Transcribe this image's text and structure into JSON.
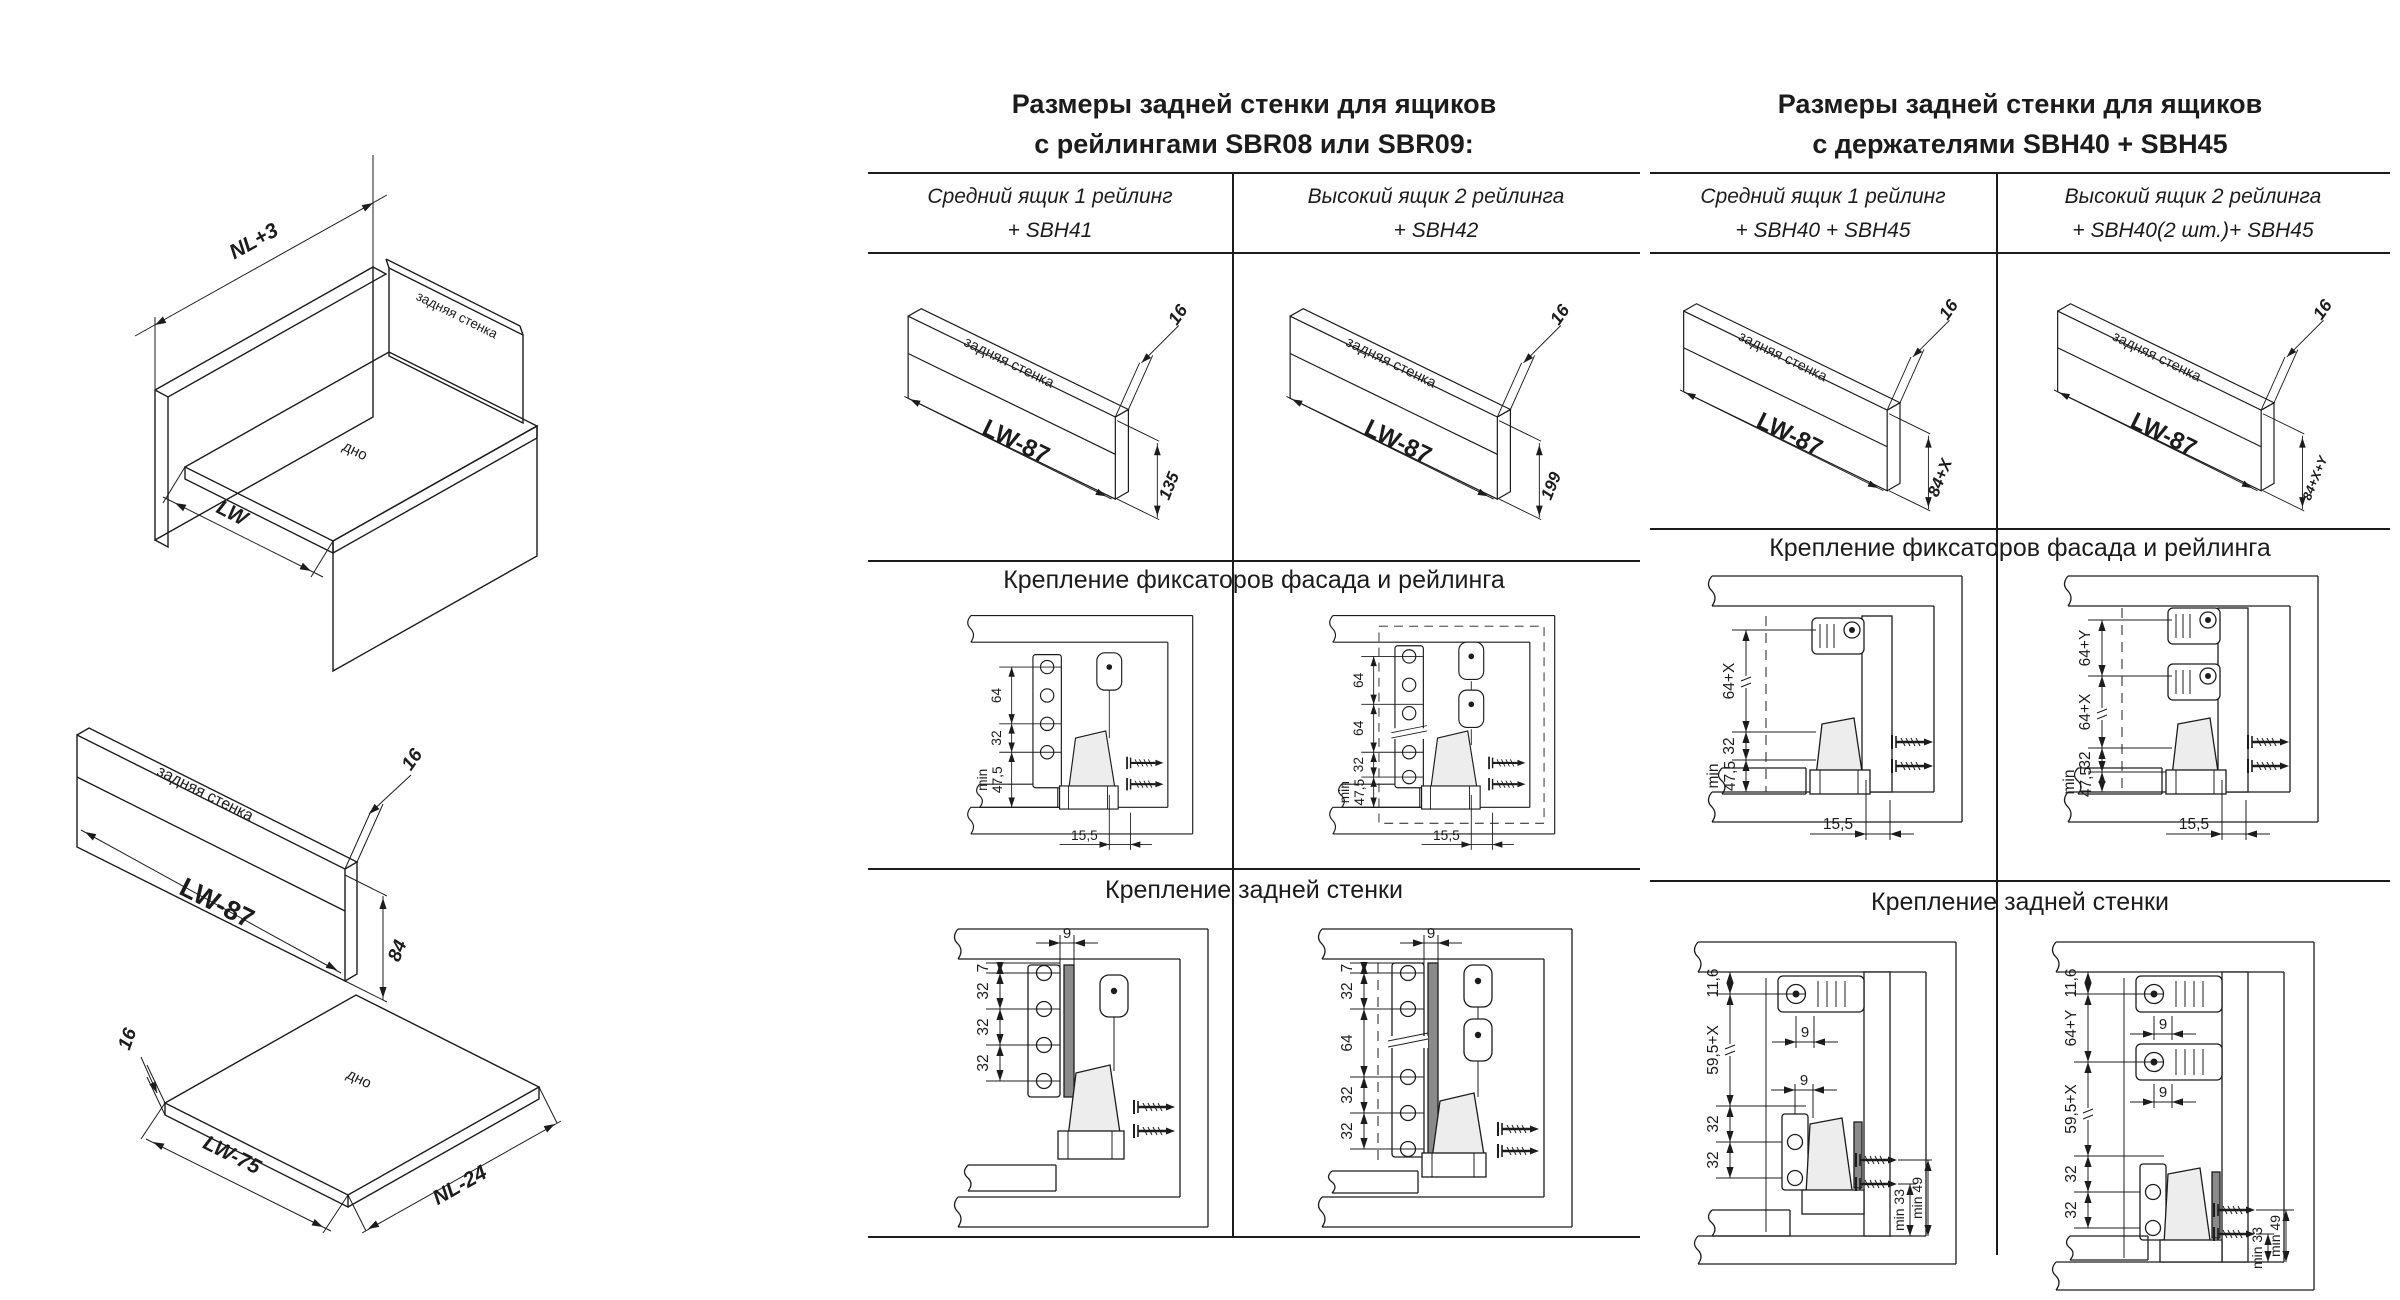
{
  "left_drawing": {
    "dim_length": "NL+3",
    "dim_width": "LW",
    "box_back_label": "задняя стенка",
    "box_bottom_label": "дно",
    "back_panel": {
      "name": "задняя стенка",
      "width": "LW-87",
      "thickness": "16",
      "height": "84"
    },
    "bottom_panel": {
      "name": "дно",
      "thickness": "16",
      "width": "LW-75",
      "depth": "NL-24"
    }
  },
  "tables": [
    {
      "title_line1": "Размеры задней стенки для ящиков",
      "title_line2": "с рейлингами SBR08 или SBR09:",
      "columns": [
        {
          "header_line1": "Средний ящик 1 рейлинг",
          "header_line2": "+ SBH41",
          "panel": {
            "name": "задняя стенка",
            "width": "LW-87",
            "thickness": "16",
            "height": "135"
          }
        },
        {
          "header_line1": "Высокий ящик 2 рейлинга",
          "header_line2": "+ SBH42",
          "panel": {
            "name": "задняя стенка",
            "width": "LW-87",
            "thickness": "16",
            "height": "199"
          }
        }
      ],
      "section1_title": "Крепление фиксаторов фасада и рейлинга",
      "section2_title": "Крепление задней стенки",
      "mount1": [
        {
          "type": "A",
          "chain": [
            "64",
            "32"
          ],
          "min_label": "min",
          "min_value": "47,5",
          "bottom": "15,5"
        },
        {
          "type": "A2",
          "chain": [
            "64",
            "64",
            "32"
          ],
          "min_label": "min",
          "min_value": "47,5",
          "bottom": "15,5"
        }
      ],
      "mount2": [
        {
          "type": "B",
          "top": "9",
          "chain": [
            "7",
            "32",
            "32",
            "32"
          ]
        },
        {
          "type": "B2",
          "top": "9",
          "chain": [
            "7",
            "32",
            "64",
            "32",
            "32"
          ]
        }
      ]
    },
    {
      "title_line1": "Размеры задней стенки для ящиков",
      "title_line2": "с держателями SBH40 + SBH45",
      "columns": [
        {
          "header_line1": "Средний ящик 1 рейлинг",
          "header_line2": "+ SBH40 + SBH45",
          "panel": {
            "name": "задняя стенка",
            "width": "LW-87",
            "thickness": "16",
            "height": "84+X"
          }
        },
        {
          "header_line1": "Высокий ящик 2 рейлинга",
          "header_line2": "+ SBH40(2 шт.)+ SBH45",
          "panel": {
            "name": "задняя стенка",
            "width": "LW-87",
            "thickness": "16",
            "height": "84+X+Y"
          }
        }
      ],
      "section1_title": "Крепление фиксаторов фасада и рейлинга",
      "section2_title": "Крепление задней стенки",
      "mount1": [
        {
          "type": "C",
          "chain": [
            "64+X",
            "32"
          ],
          "min_label": "min",
          "min_value": "47,5",
          "bottom": "15,5"
        },
        {
          "type": "C2",
          "chain": [
            "64+Y",
            "64+X",
            "32"
          ],
          "min_label": "min",
          "min_value": "47,5",
          "bottom": "15,5"
        }
      ],
      "mount2": [
        {
          "type": "D",
          "chain": [
            "11,6",
            "59,5+X",
            "32",
            "32"
          ],
          "hole_gap": "9",
          "min_back": "min 33",
          "min_front": "min 49"
        },
        {
          "type": "D2",
          "chain": [
            "11,6",
            "64+Y",
            "59,5+X",
            "32",
            "32"
          ],
          "hole_gap": "9",
          "min_back": "min 33",
          "min_front": "min 49"
        }
      ]
    }
  ]
}
